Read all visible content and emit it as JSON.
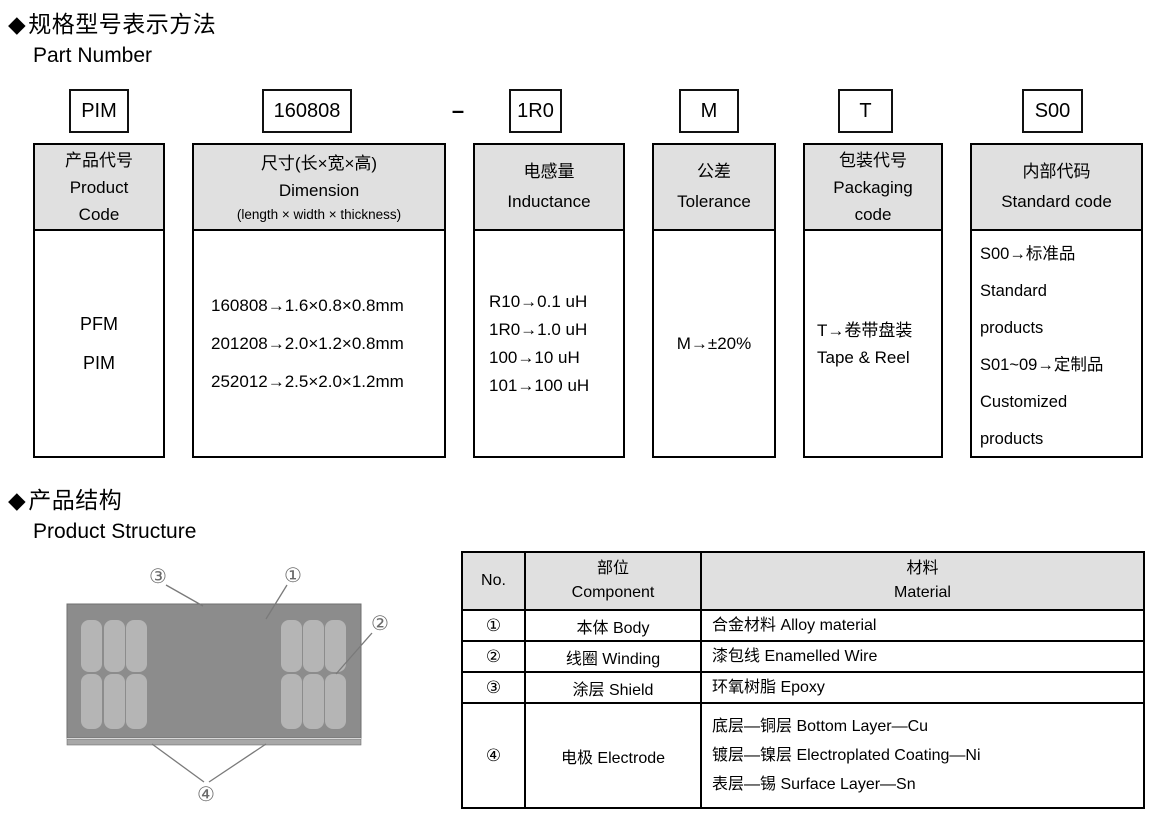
{
  "section1": {
    "bullet": "◆",
    "title_zh": "规格型号表示方法",
    "title_en": "Part Number"
  },
  "part_number": {
    "boxes": [
      "PIM",
      "160808",
      "1R0",
      "M",
      "T",
      "S00"
    ],
    "separator": "–"
  },
  "part_table": {
    "header_bg": "#e0e0e0",
    "columns": [
      {
        "header_zh": "产品代号",
        "header_en": "Product",
        "header_en2": "Code",
        "body_lines": [
          "PFM",
          "PIM"
        ]
      },
      {
        "header_zh": "尺寸(长×宽×高)",
        "header_en": "Dimension",
        "header_small": "(length × width × thickness)",
        "body_lines": [
          "160808→1.6×0.8×0.8mm",
          "201208→2.0×1.2×0.8mm",
          "252012→2.5×2.0×1.2mm"
        ]
      },
      {
        "header_zh": "电感量",
        "header_en": "Inductance",
        "body_lines": [
          "R10→0.1 uH",
          "1R0→1.0 uH",
          "100→10 uH",
          "101→100 uH"
        ]
      },
      {
        "header_zh": "公差",
        "header_en": "Tolerance",
        "body_lines": [
          "M→±20%"
        ]
      },
      {
        "header_zh": "包装代号",
        "header_en": "Packaging",
        "header_en2": "code",
        "body_lines": [
          "T→卷带盘装",
          "Tape & Reel"
        ]
      },
      {
        "header_zh": "内部代码",
        "header_en": "Standard code",
        "body_lines": [
          "S00→标准品",
          "Standard",
          "products",
          "S01~09→定制品",
          "Customized",
          "products"
        ]
      }
    ]
  },
  "section2": {
    "bullet": "◆",
    "title_zh": "产品结构",
    "title_en": "Product Structure"
  },
  "diagram": {
    "body_color": "#8c8c8c",
    "pad_color": "#b5b5b5",
    "strip_color": "#a8a8a8",
    "labels": {
      "l1": "①",
      "l2": "②",
      "l3": "③",
      "l4": "④"
    }
  },
  "structure_table": {
    "header": {
      "no": "No.",
      "component_zh": "部位",
      "component_en": "Component",
      "material_zh": "材料",
      "material_en": "Material"
    },
    "rows": [
      {
        "no": "①",
        "component": "本体 Body",
        "material1": "合金材料 Alloy material"
      },
      {
        "no": "②",
        "component": "线圈 Winding",
        "material1": "漆包线 Enamelled Wire"
      },
      {
        "no": "③",
        "component": "涂层 Shield",
        "material1": "环氧树脂 Epoxy"
      },
      {
        "no": "④",
        "component": "电极 Electrode",
        "material1": "底层—铜层 Bottom Layer—Cu",
        "material2": "镀层—镍层 Electroplated Coating—Ni",
        "material3": "表层—锡 Surface Layer—Sn"
      }
    ]
  }
}
